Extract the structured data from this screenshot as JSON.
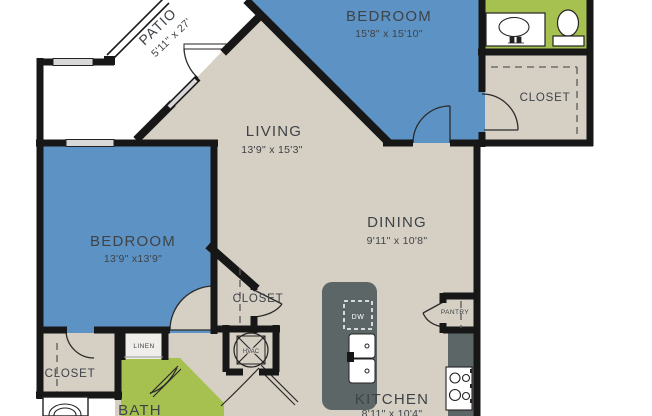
{
  "rooms": {
    "patio": {
      "label": "PATIO",
      "dims": "5'11\" x 27'"
    },
    "bedroom_top": {
      "label": "BEDROOM",
      "dims": "15'8\" x 15'10\""
    },
    "bedroom_left": {
      "label": "BEDROOM",
      "dims": "13'9\" x13'9\""
    },
    "living": {
      "label": "LIVING",
      "dims": "13'9\" x 15'3\""
    },
    "dining": {
      "label": "DINING",
      "dims": "9'11\" x 10'8\""
    },
    "kitchen": {
      "label": "KITCHEN",
      "dims": "8'11\" x 10'4\""
    },
    "bath": {
      "label": "BATH"
    },
    "closet_top_right": {
      "label": "CLOSET"
    },
    "closet_hall": {
      "label": "CLOSET"
    },
    "closet_bottom_left": {
      "label": "CLOSET"
    },
    "linen": {
      "label": "LINEN"
    },
    "pantry": {
      "label": "PANTRY"
    },
    "hvac": {
      "label": "HVAC"
    },
    "dishwasher": {
      "label": "DW"
    }
  },
  "colors": {
    "floor": "#d6cfc4",
    "bedroom": "#5d93c4",
    "bath": "#a7c150",
    "counter": "#5c6666",
    "wall": "#171717",
    "window": "#d8d8d8",
    "text": "#3e4347"
  }
}
